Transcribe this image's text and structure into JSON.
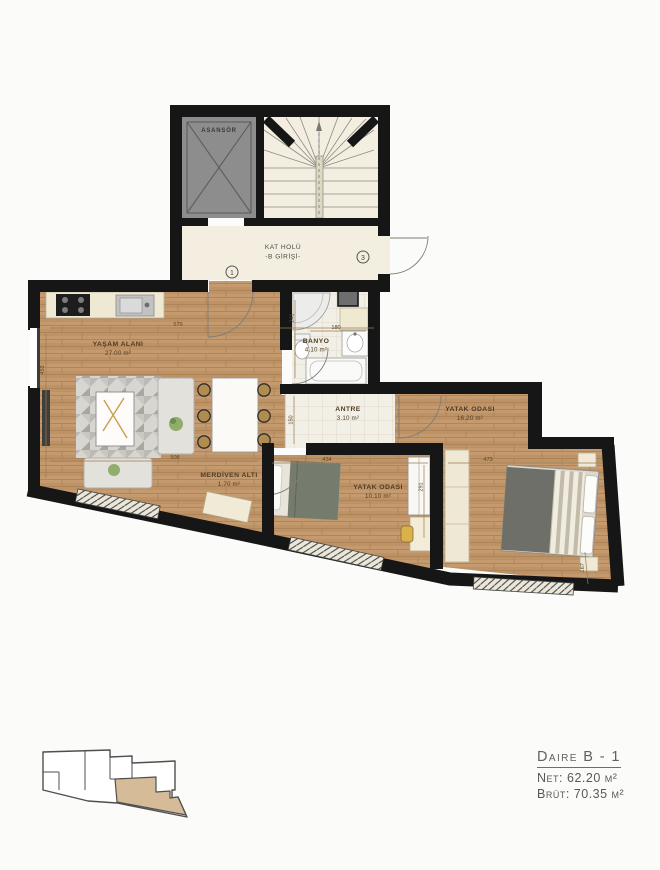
{
  "stairwell": {
    "elevator_label": "ASANSÖR",
    "hall_label_line1": "KAT HOLÜ",
    "hall_label_line2": "-B GİRİŞİ-",
    "door_circle_1": "1",
    "door_circle_3": "3"
  },
  "rooms": {
    "living": {
      "name": "YAŞAM ALANI",
      "area": "27.00 m²"
    },
    "bathroom": {
      "name": "BANYO",
      "area": "4.10 m²"
    },
    "entry_hall": {
      "name": "ANTRE",
      "area": "3.10 m²"
    },
    "under_stairs": {
      "name": "MERDİVEN ALTI",
      "area": "1.70 m²"
    },
    "bedroom_small": {
      "name": "YATAK ODASI",
      "area": "10.10 m²"
    },
    "bedroom_large": {
      "name": "YATAK ODASI",
      "area": "16.20 m²"
    }
  },
  "dimensions": {
    "living_top": "579",
    "living_left": "453",
    "living_bottom": "508",
    "bathroom_left": "241",
    "bathroom_top": "180",
    "entry_left": "150",
    "bedroom_small_top": "434",
    "bedroom_small_right": "291",
    "bedroom_large_top": "473",
    "bedroom_large_right": "167"
  },
  "info": {
    "unit_title": "Daire B - 1",
    "net_label": "Net:",
    "net_value": "62.20 m²",
    "brut_label": "Brüt:",
    "brut_value": "70.35 m²"
  },
  "colors": {
    "wall": "#161616",
    "wood_floor": "#c49a6e",
    "tile_floor": "#f2efe7",
    "hall_floor": "#f3eee0",
    "elevator_fill": "#8d8d8d",
    "keyplan_highlight": "#d5bb97",
    "dimension_text": "#5d4526",
    "info_text": "#5f5f5f"
  }
}
